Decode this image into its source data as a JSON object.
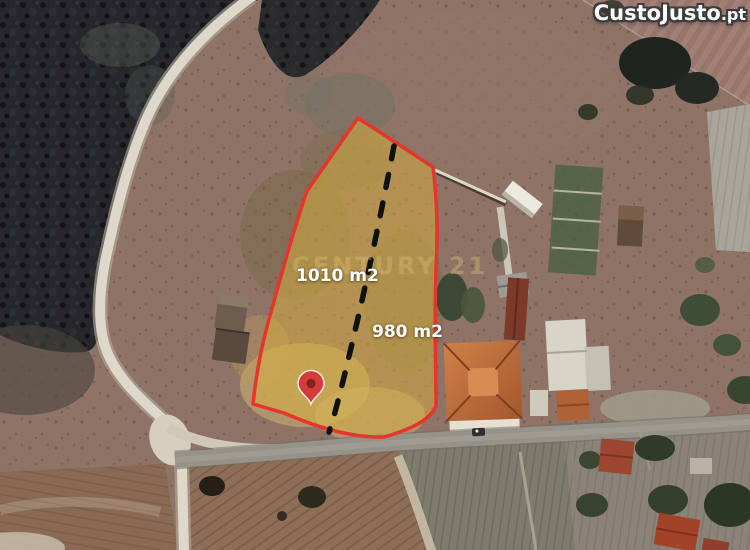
{
  "site": {
    "logo": {
      "name": "CustoJusto",
      "suffix": ".pt"
    }
  },
  "map": {
    "watermark": "CENTURY 21",
    "parcel": {
      "outline_color": "#e5352c",
      "fill_color": "#d9b23c",
      "divider_color": "#111111",
      "sections": [
        {
          "area_label": "1010 m2"
        },
        {
          "area_label": "980 m2"
        }
      ]
    },
    "marker": {
      "type": "location-pin",
      "color": "#d23c39",
      "dot_color": "#8c1e22"
    }
  }
}
